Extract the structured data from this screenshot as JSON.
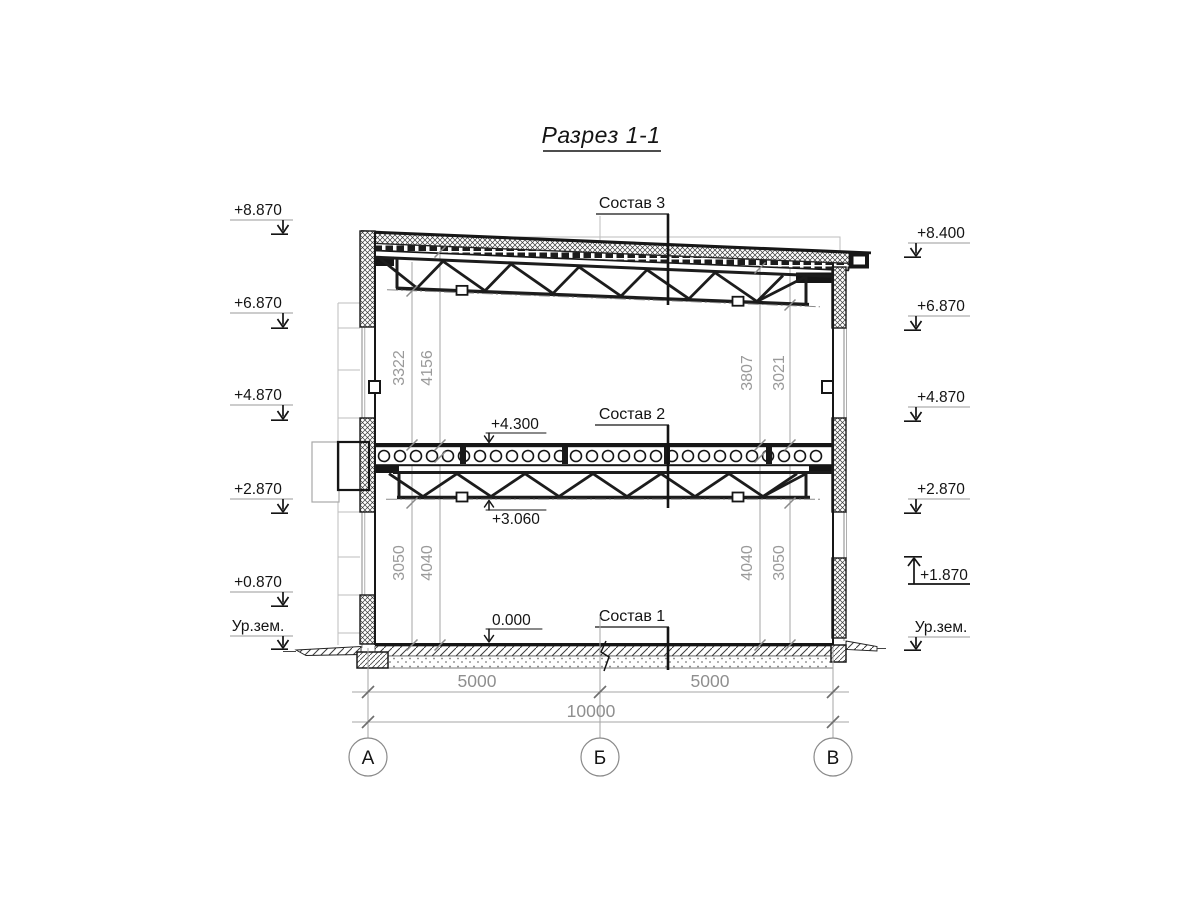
{
  "title": "Разрез 1-1",
  "composition_labels": {
    "roof": "Состав 3",
    "floor": "Состав 2",
    "ground": "Состав 1"
  },
  "internal_marks": {
    "floor_top": "+4.300",
    "floor_truss_bottom": "+3.060",
    "ground_floor": "0.000"
  },
  "elevations_left": [
    "+8.870",
    "+6.870",
    "+4.870",
    "+2.870",
    "+0.870",
    "Ур.зем."
  ],
  "elevations_right": [
    "+8.400",
    "+6.870",
    "+4.870",
    "+2.870",
    "+1.870",
    "Ур.зем."
  ],
  "vertical_dims": {
    "upper_left": [
      "3322",
      "4156"
    ],
    "upper_right": [
      "3807",
      "3021"
    ],
    "lower_left": [
      "3050",
      "4040"
    ],
    "lower_right": [
      "4040",
      "3050"
    ]
  },
  "horizontal_dims": {
    "span_ab": "5000",
    "span_bv": "5000",
    "total": "10000"
  },
  "axes": {
    "a": "А",
    "b": "Б",
    "v": "В"
  },
  "colors": {
    "line": "#1a1a1a",
    "dim_gray": "#9a9a9a",
    "faint": "#bdbdbd"
  }
}
